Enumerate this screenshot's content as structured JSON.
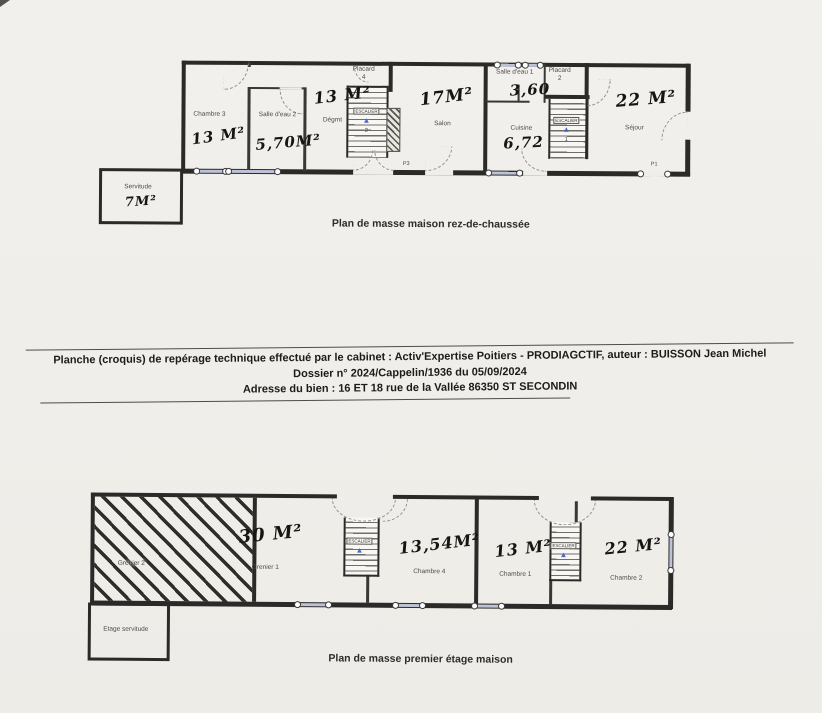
{
  "doc": {
    "line1": "Planche (croquis) de repérage technique effectué par le cabinet : Activ'Expertise Poitiers - PRODIAGCTIF, auteur : BUISSON Jean Michel",
    "line2": "Dossier n° 2024/Cappelin/1936 du 05/09/2024",
    "line3": "Adresse du bien : 16 ET 18 rue de la Vallée  86350 ST SECONDIN"
  },
  "gf": {
    "caption": "Plan de masse maison rez-de-chaussée",
    "rooms": [
      {
        "name": "Chambre 3",
        "area": "13 M²"
      },
      {
        "name": "Salle d'eau 2",
        "area": "5,70M²"
      },
      {
        "name": "Dégmt",
        "area": "13 M²"
      },
      {
        "name": "Salon",
        "area": "17M²"
      },
      {
        "name": "Salle d'eau 1",
        "area": "3,60"
      },
      {
        "name": "Cuisine",
        "area": "6,72"
      },
      {
        "name": "Séjour",
        "area": "22 M²"
      },
      {
        "name": "Servitude",
        "area": "7M²"
      }
    ],
    "placard4": {
      "label": "Placard",
      "num": "4"
    },
    "placard2": {
      "label": "Placard",
      "num": "2"
    },
    "stair_left": {
      "label": "escalier",
      "num": "2"
    },
    "stair_right": {
      "label": "escalier",
      "num": "1"
    },
    "p3": "P3",
    "p1": "P1"
  },
  "ff": {
    "caption": "Plan de masse premier étage maison",
    "rooms": [
      {
        "name": "Grenier 2",
        "area": ""
      },
      {
        "name": "Grenier 1",
        "area": "30 M²"
      },
      {
        "name": "Chambre 4",
        "area": "13,54M²"
      },
      {
        "name": "Chambre 1",
        "area": "13 M²"
      },
      {
        "name": "Chambre 2",
        "area": "22 M²"
      },
      {
        "name": "Etage servitude",
        "area": ""
      }
    ],
    "stair_left": {
      "label": "escalier"
    },
    "stair_right": {
      "label": "escalier"
    }
  },
  "colors": {
    "paper": "#f0eeea",
    "wall": "#2b2a28",
    "handwriting": "#171411",
    "print_label": "#4d4c49",
    "stair_arrow_blue": "#4a6ac6",
    "window": "#bcc3d6"
  }
}
